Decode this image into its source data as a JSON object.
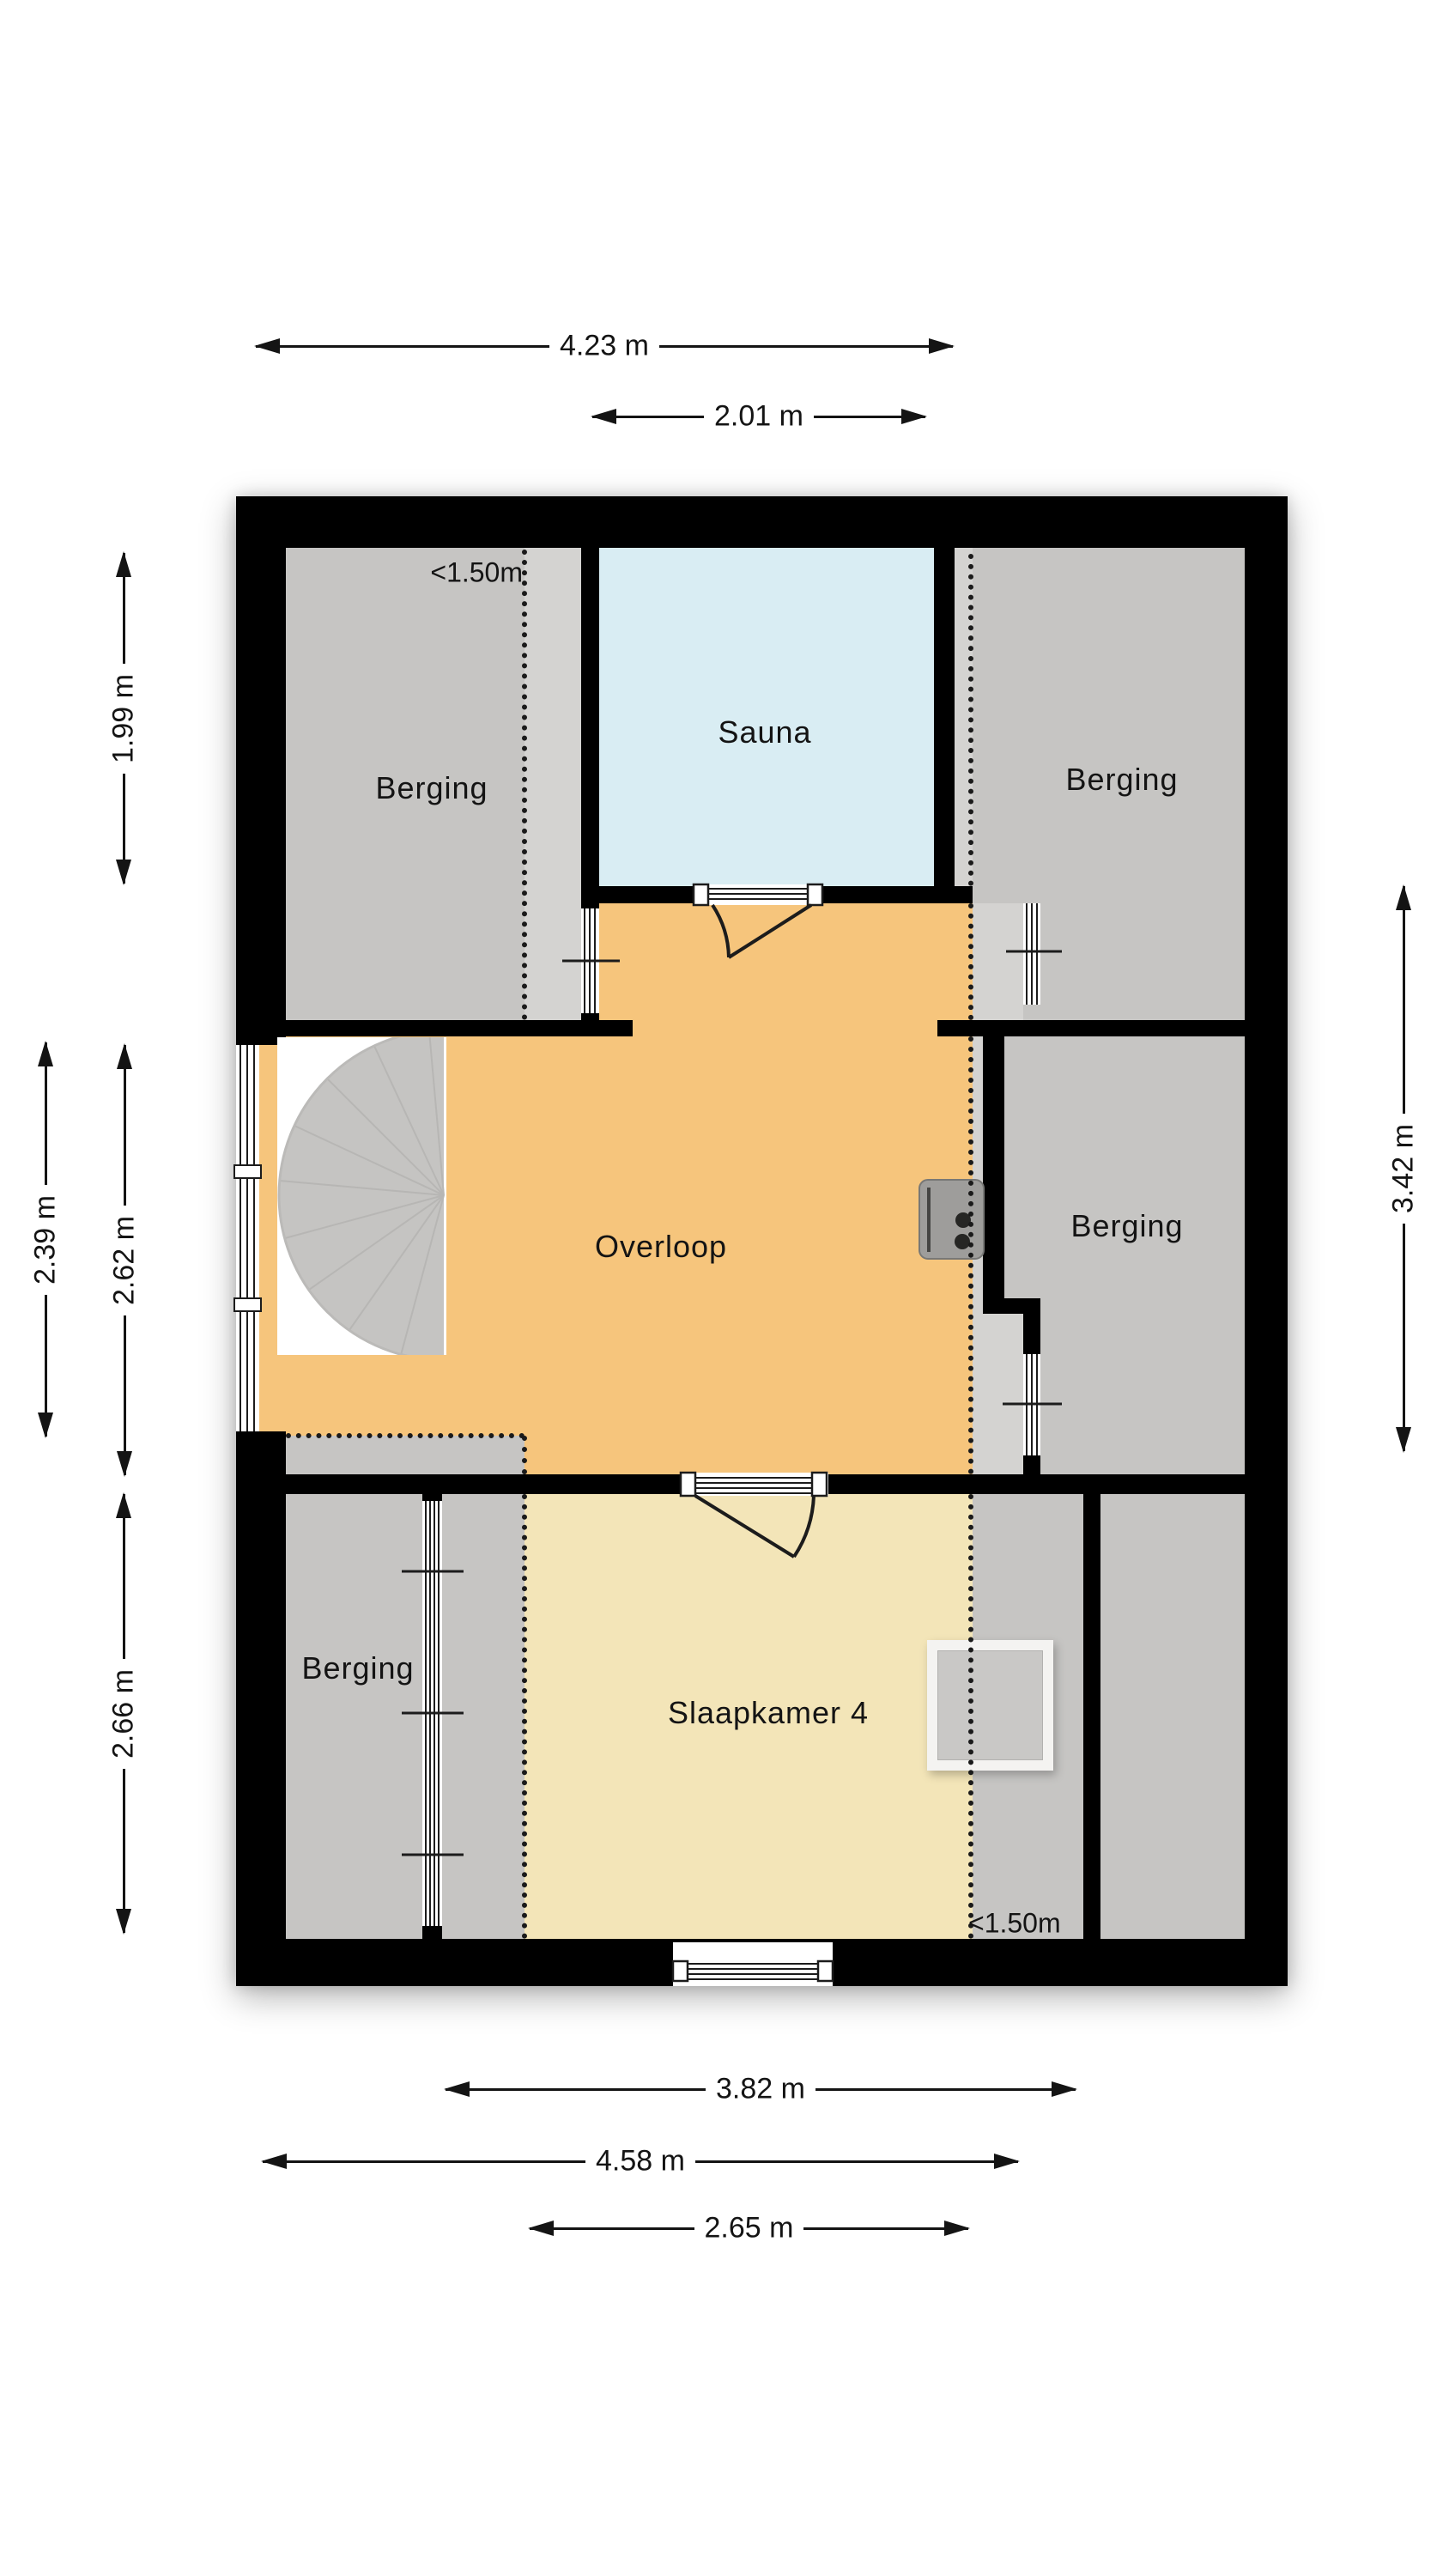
{
  "floorplan": {
    "rooms": [
      {
        "id": "berging-top-left",
        "label": "Berging"
      },
      {
        "id": "sauna",
        "label": "Sauna"
      },
      {
        "id": "berging-top-right",
        "label": "Berging"
      },
      {
        "id": "overloop",
        "label": "Overloop"
      },
      {
        "id": "berging-right",
        "label": "Berging"
      },
      {
        "id": "berging-bottom-left",
        "label": "Berging"
      },
      {
        "id": "slaapkamer-4",
        "label": "Slaapkamer 4"
      }
    ],
    "annotations": [
      {
        "id": "low-headroom-top",
        "text": "<1.50m"
      },
      {
        "id": "low-headroom-bottom",
        "text": "<1.50m"
      }
    ],
    "dimensions": {
      "top": [
        {
          "id": "top-overall",
          "value": "4.23 m"
        },
        {
          "id": "top-sauna",
          "value": "2.01 m"
        }
      ],
      "left": [
        {
          "id": "left-band-1",
          "value": "1.99 m"
        },
        {
          "id": "left-band-2",
          "value": "2.39 m"
        },
        {
          "id": "left-band-3",
          "value": "2.62 m"
        },
        {
          "id": "left-band-4",
          "value": "2.66 m"
        }
      ],
      "right": [
        {
          "id": "right-band",
          "value": "3.42 m"
        }
      ],
      "bottom": [
        {
          "id": "bottom-room",
          "value": "3.82 m"
        },
        {
          "id": "bottom-overall",
          "value": "4.58 m"
        },
        {
          "id": "bottom-between",
          "value": "2.65 m"
        }
      ]
    },
    "colors": {
      "wall": "#000000",
      "room_gray": "#c6c5c3",
      "room_gray_light": "#d4d3d1",
      "overloop_orange": "#f6c57c",
      "slaapkamer_yellow": "#f3e5b8",
      "sauna_blue": "#d9edf3",
      "background": "#ffffff"
    }
  }
}
